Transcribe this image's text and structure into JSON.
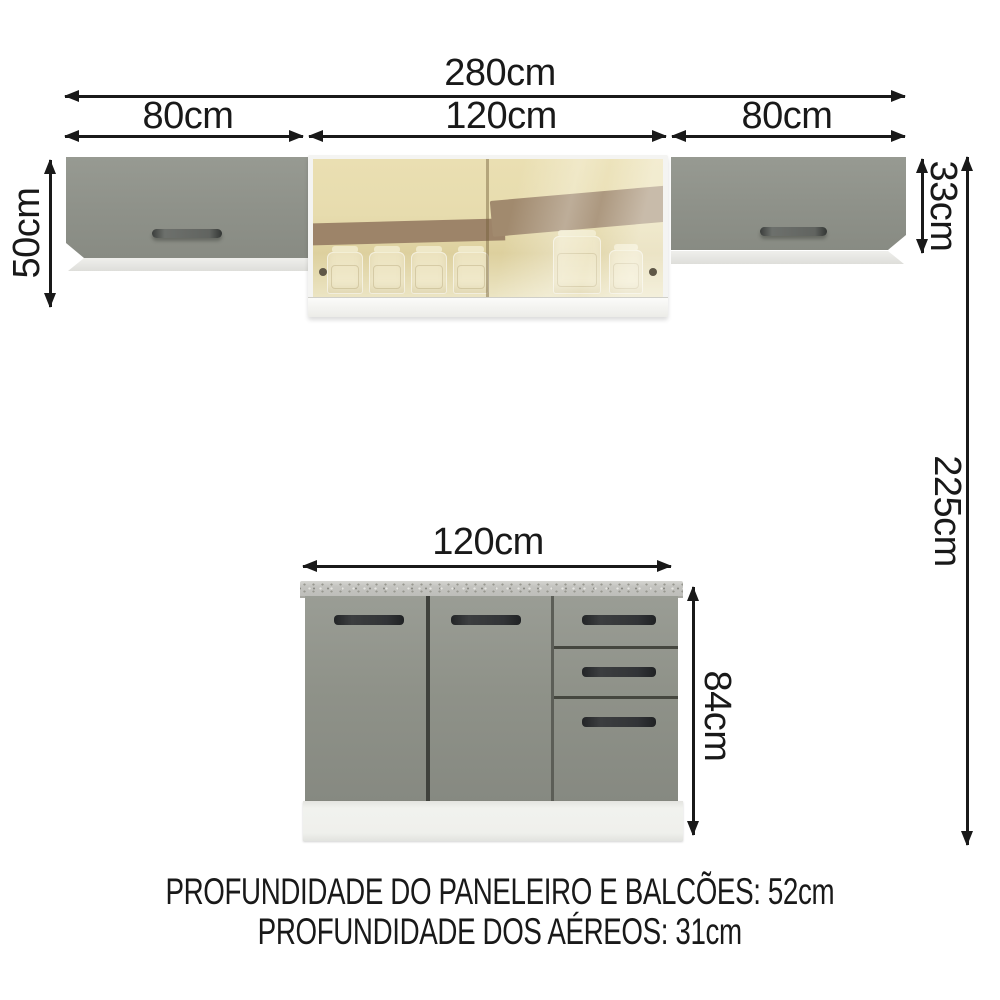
{
  "diagram": {
    "wall_section": {
      "total_width_label": "280cm",
      "left_cabinet_width_label": "80cm",
      "center_cabinet_width_label": "120cm",
      "right_cabinet_width_label": "80cm",
      "left_cabinet_height_label": "50cm",
      "right_cabinet_height_label": "33cm",
      "total_height_label": "225cm"
    },
    "base_section": {
      "width_label": "120cm",
      "height_label": "84cm"
    },
    "footer": {
      "depth_pantry_counters": "PROFUNDIDADE DO PANELEIRO E BALCÕES: 52cm",
      "depth_wall_cabinets": "PROFUNDIDADE DOS AÉREOS: 31cm"
    },
    "colors": {
      "background": "#ffffff",
      "dimension_ink": "#191919",
      "cabinet_front_gray": "#8f9289",
      "handle_dark": "#2d2f31",
      "glass_tint_amber": "#e7dcae",
      "glass_reflection_brown": "#9d8469",
      "countertop_speckle_gray": "#c7c7c3",
      "plinth_white": "#f0f1ed",
      "frame_white": "#f4f4f2"
    }
  }
}
